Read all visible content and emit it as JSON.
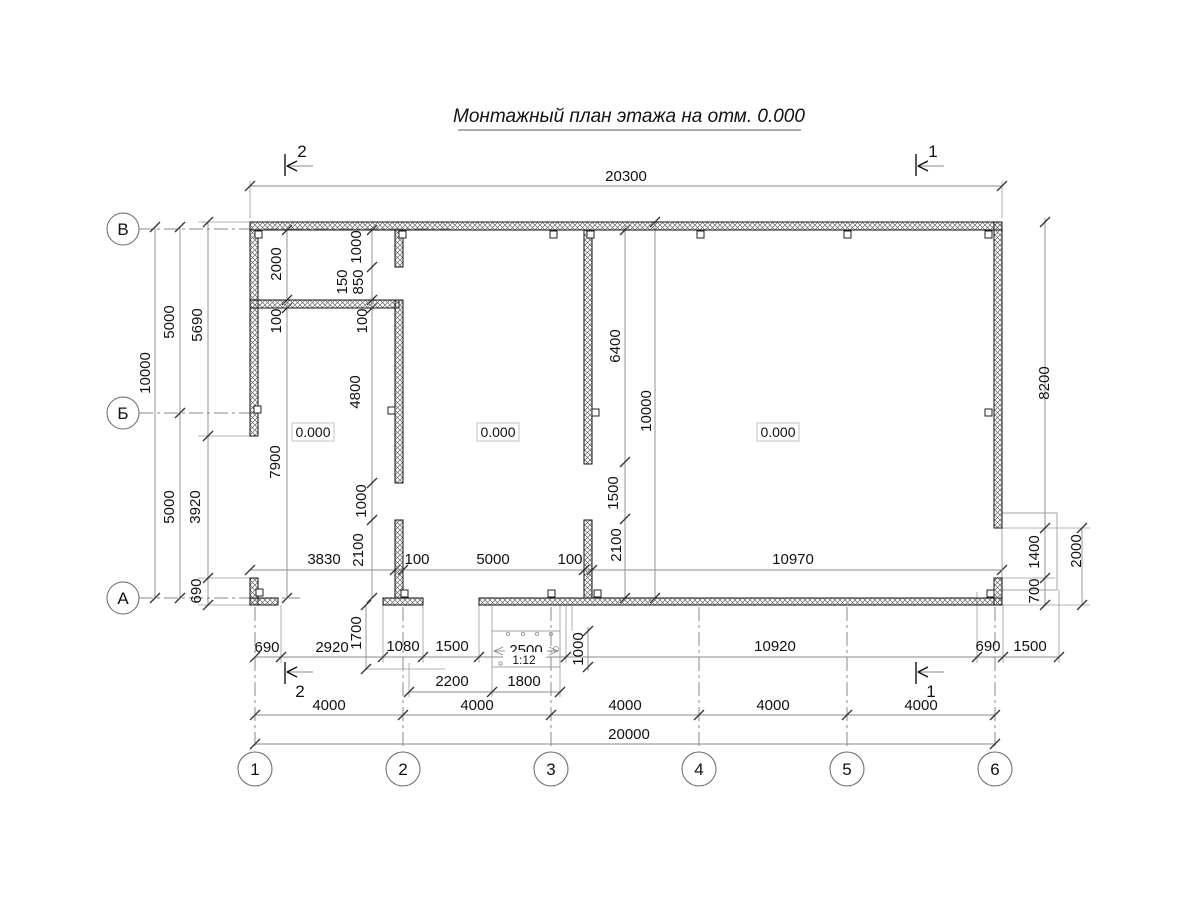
{
  "title": "Монтажный план этажа на отм. 0.000",
  "rooms": {
    "elevations": [
      "0.000",
      "0.000",
      "0.000"
    ]
  },
  "axes": {
    "bottom": [
      "1",
      "2",
      "3",
      "4",
      "5",
      "6"
    ],
    "left": [
      "В",
      "Б",
      "А"
    ]
  },
  "sections": {
    "top_left": "2",
    "top_right": "1",
    "bottom_left": "2",
    "bottom_right": "1"
  },
  "ramp": {
    "length_label": "2500",
    "slope": "1:12",
    "width_label": "1000"
  },
  "dims": {
    "top_overall": "20300",
    "bottom_overall": "20000",
    "spacing": [
      "4000",
      "4000",
      "4000",
      "4000",
      "4000"
    ],
    "left_total": "10000",
    "left_spans": [
      "5000",
      "5000"
    ],
    "left_chain": [
      "5690",
      "3920",
      "690"
    ],
    "right_wall": "8200",
    "right_chain": [
      "1400",
      "700"
    ],
    "right_opening_total": "2000",
    "col2_chain": [
      "2000",
      "100",
      "7900"
    ],
    "colA_chain": [
      "1000",
      "850",
      "150",
      "100",
      "4800",
      "1000",
      "2100"
    ],
    "colB_chain": [
      "6400",
      "1500",
      "2100"
    ],
    "interior_height": "10000",
    "mid_chain": [
      "3830",
      "100",
      "5000",
      "100",
      "10970"
    ],
    "bottom_chain": [
      "690",
      "2920",
      "1700",
      "1080",
      "1500",
      "10920",
      "690",
      "1500"
    ],
    "porch_chain": [
      "2200",
      "1800"
    ]
  }
}
